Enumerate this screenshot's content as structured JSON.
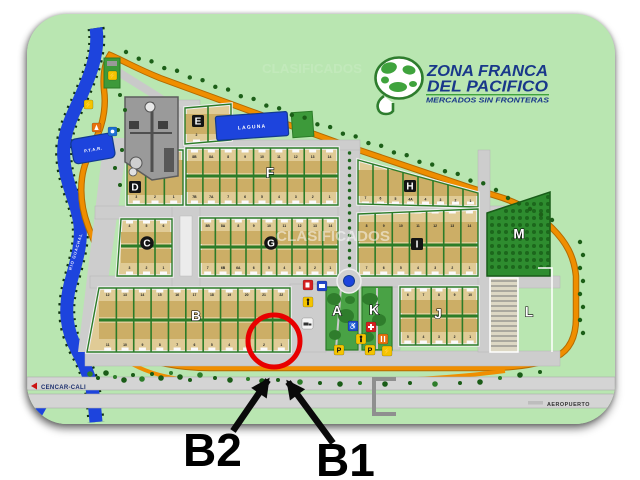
{
  "logo": {
    "line1": "ZONA FRANCA",
    "line2": "DEL PACIFICO",
    "tagline": "MERCADOS SIN FRONTERAS"
  },
  "watermark": {
    "text": "CLASIFICADOS"
  },
  "annotations": {
    "b2_label": "B2",
    "b1_label": "B1"
  },
  "map": {
    "road_labels": {
      "cencar": "CENCAR-CALI",
      "aeropuerto": "AEROPUERTO",
      "river": "RIO GUACHAL"
    },
    "areas": {
      "laguna": "LAGUNA",
      "ptar": "P.T.A.R."
    },
    "blocks": [
      {
        "id": "A",
        "label": "A"
      },
      {
        "id": "B",
        "label": "B",
        "lots_top": [
          "12",
          "13",
          "14",
          "15",
          "16",
          "17",
          "18",
          "19",
          "20",
          "21",
          "22"
        ],
        "lots_bottom": [
          "11",
          "10",
          "9",
          "8",
          "7",
          "6",
          "5",
          "4",
          "3",
          "2",
          "1"
        ]
      },
      {
        "id": "C",
        "label": "C",
        "lots_top": [
          "4",
          "5",
          "6"
        ],
        "lots_bottom": [
          "3",
          "2",
          "1"
        ]
      },
      {
        "id": "D",
        "label": "D",
        "lots": [
          "3",
          "2",
          "1"
        ]
      },
      {
        "id": "E",
        "label": "E",
        "lots": [
          "2",
          "1"
        ]
      },
      {
        "id": "F",
        "label": "F",
        "lots_top": [
          "8B",
          "8A",
          "8",
          "9",
          "10",
          "11",
          "12",
          "13",
          "14"
        ],
        "lots_bottom": [
          "7B",
          "7A",
          "7",
          "6",
          "5",
          "4",
          "3",
          "2",
          "1"
        ]
      },
      {
        "id": "G",
        "label": "G",
        "lots_top": [
          "8B",
          "8A",
          "8",
          "9",
          "10",
          "11",
          "12",
          "13",
          "14"
        ],
        "lots_bottom": [
          "7",
          "6B",
          "6A",
          "6",
          "5",
          "4",
          "3",
          "2",
          "1"
        ]
      },
      {
        "id": "H",
        "label": "H",
        "lots": [
          "7",
          "6",
          "5",
          "4A",
          "4",
          "3",
          "2",
          "1"
        ]
      },
      {
        "id": "I",
        "label": "I",
        "lots_top": [
          "8",
          "9",
          "10",
          "11",
          "12",
          "13",
          "14"
        ],
        "lots_bottom": [
          "7",
          "6",
          "5",
          "4",
          "3",
          "2",
          "1"
        ]
      },
      {
        "id": "J",
        "label": "J",
        "lots_top": [
          "6",
          "7",
          "8",
          "9",
          "10"
        ],
        "lots_bottom": [
          "5",
          "4",
          "3",
          "2",
          "1"
        ]
      },
      {
        "id": "K",
        "label": "K"
      },
      {
        "id": "L",
        "label": "L"
      },
      {
        "id": "M",
        "label": "M"
      }
    ],
    "signs": [
      {
        "name": "fuel-station-sign"
      },
      {
        "name": "bus-stop-sign"
      },
      {
        "name": "pedestrian-crossing-sign"
      },
      {
        "name": "truck-route-sign"
      },
      {
        "name": "accessibility-sign"
      },
      {
        "name": "first-aid-sign"
      },
      {
        "name": "pedestrian-crossing-sign-2"
      },
      {
        "name": "restaurant-sign"
      },
      {
        "name": "parking-sign-1",
        "text": "P"
      },
      {
        "name": "parking-sign-2",
        "text": "P"
      },
      {
        "name": "electric-power-sign"
      },
      {
        "name": "power-substation-sign"
      },
      {
        "name": "gas-flame-sign"
      },
      {
        "name": "water-supply-sign"
      },
      {
        "name": "entrance-gate-sign"
      }
    ]
  },
  "colors": {
    "map_background": "#b9e6b1",
    "river_blue": "#1d44dd",
    "perimeter_orange": "#ef8e00",
    "lot_tan": "#e0cb96",
    "block_green_border": "#2c7c28",
    "annotation_red": "#e80000",
    "logo_blue": "#19388a",
    "logo_green": "#3fa33d"
  }
}
